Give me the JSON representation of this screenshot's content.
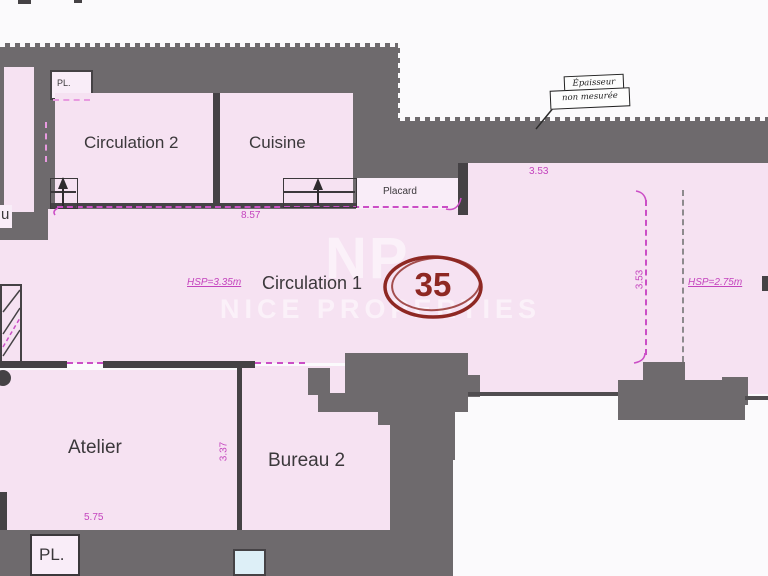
{
  "labels": {
    "circulation2": "Circulation 2",
    "cuisine": "Cuisine",
    "circulation1": "Circulation 1",
    "atelier": "Atelier",
    "bureau2": "Bureau 2",
    "pl_top": "PL.",
    "pl_bottom": "PL.",
    "placard": "Placard",
    "left_partial": "u",
    "lot_number": "35"
  },
  "dims": {
    "d857": "8.57",
    "d353_top": "3.53",
    "d353_mid": "3.53",
    "d575": "5.75",
    "d337": "3.37"
  },
  "hsp": {
    "main": "HSP=3.35m",
    "right": "HSP=2.75m"
  },
  "stamp": {
    "line1": "Épaisseur",
    "line2": "non mesurée"
  },
  "watermark": {
    "logo": "NP",
    "name": "NICE PROPERTIES"
  },
  "colors": {
    "wall_gray": "#6e6a6d",
    "room_pink": "#f6e2f2",
    "dim_magenta": "#c444be",
    "circle_red": "#8e2823",
    "window_blue": "#ddeff7"
  }
}
